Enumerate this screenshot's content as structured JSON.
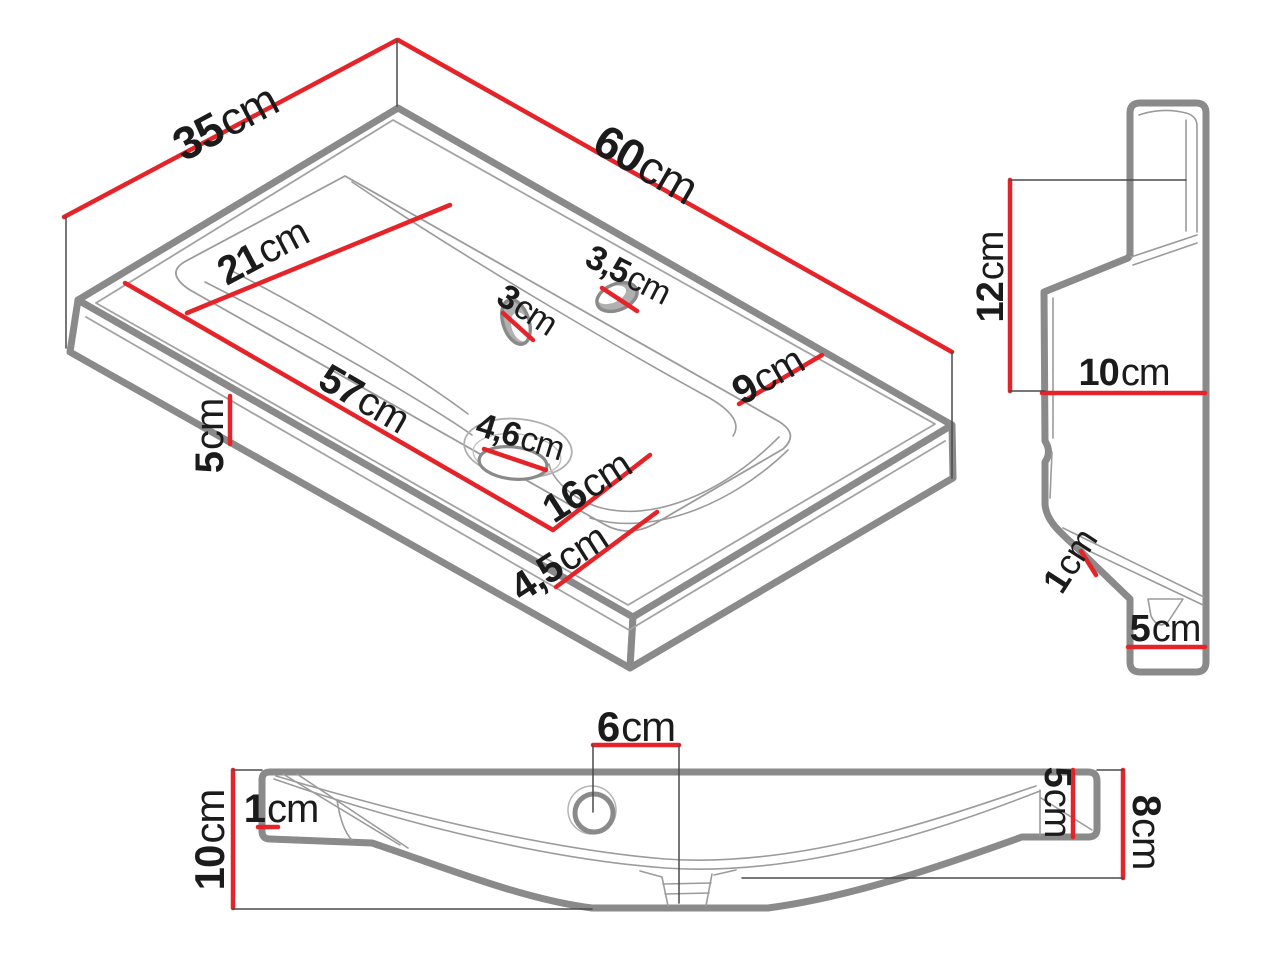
{
  "colors": {
    "dimension_red": "#e5242a",
    "outline_gray": "#8a8a8a",
    "detail_gray": "#9b9b9b",
    "label_black": "#1b1b1b",
    "background": "#ffffff"
  },
  "iso": {
    "dims": [
      {
        "id": "iso-35cm",
        "num": "35",
        "unit": "cm"
      },
      {
        "id": "iso-60cm",
        "num": "60",
        "unit": "cm"
      },
      {
        "id": "iso-21cm",
        "num": "21",
        "unit": "cm"
      },
      {
        "id": "iso-57cm",
        "num": "57",
        "unit": "cm"
      },
      {
        "id": "iso-16cm",
        "num": "16",
        "unit": "cm"
      },
      {
        "id": "iso-4_5cm",
        "num": "4,5",
        "unit": "cm"
      },
      {
        "id": "iso-9cm",
        "num": "9",
        "unit": "cm"
      },
      {
        "id": "iso-3cm",
        "num": "3",
        "unit": "cm"
      },
      {
        "id": "iso-3_5cm",
        "num": "3,5",
        "unit": "cm"
      },
      {
        "id": "iso-4_6cm",
        "num": "4,6",
        "unit": "cm"
      },
      {
        "id": "iso-5cm",
        "num": "5",
        "unit": "cm"
      }
    ]
  },
  "side": {
    "dims": [
      {
        "id": "side-12cm",
        "num": "12",
        "unit": "cm"
      },
      {
        "id": "side-10cm",
        "num": "10",
        "unit": "cm"
      },
      {
        "id": "side-1cm",
        "num": "1",
        "unit": "cm"
      },
      {
        "id": "side-5cm",
        "num": "5",
        "unit": "cm"
      }
    ]
  },
  "front": {
    "dims": [
      {
        "id": "front-10cm",
        "num": "10",
        "unit": "cm"
      },
      {
        "id": "front-1cm",
        "num": "1",
        "unit": "cm"
      },
      {
        "id": "front-6cm",
        "num": "6",
        "unit": "cm"
      },
      {
        "id": "front-5cm",
        "num": "5",
        "unit": "cm"
      },
      {
        "id": "front-8cm",
        "num": "8",
        "unit": "cm"
      }
    ]
  }
}
